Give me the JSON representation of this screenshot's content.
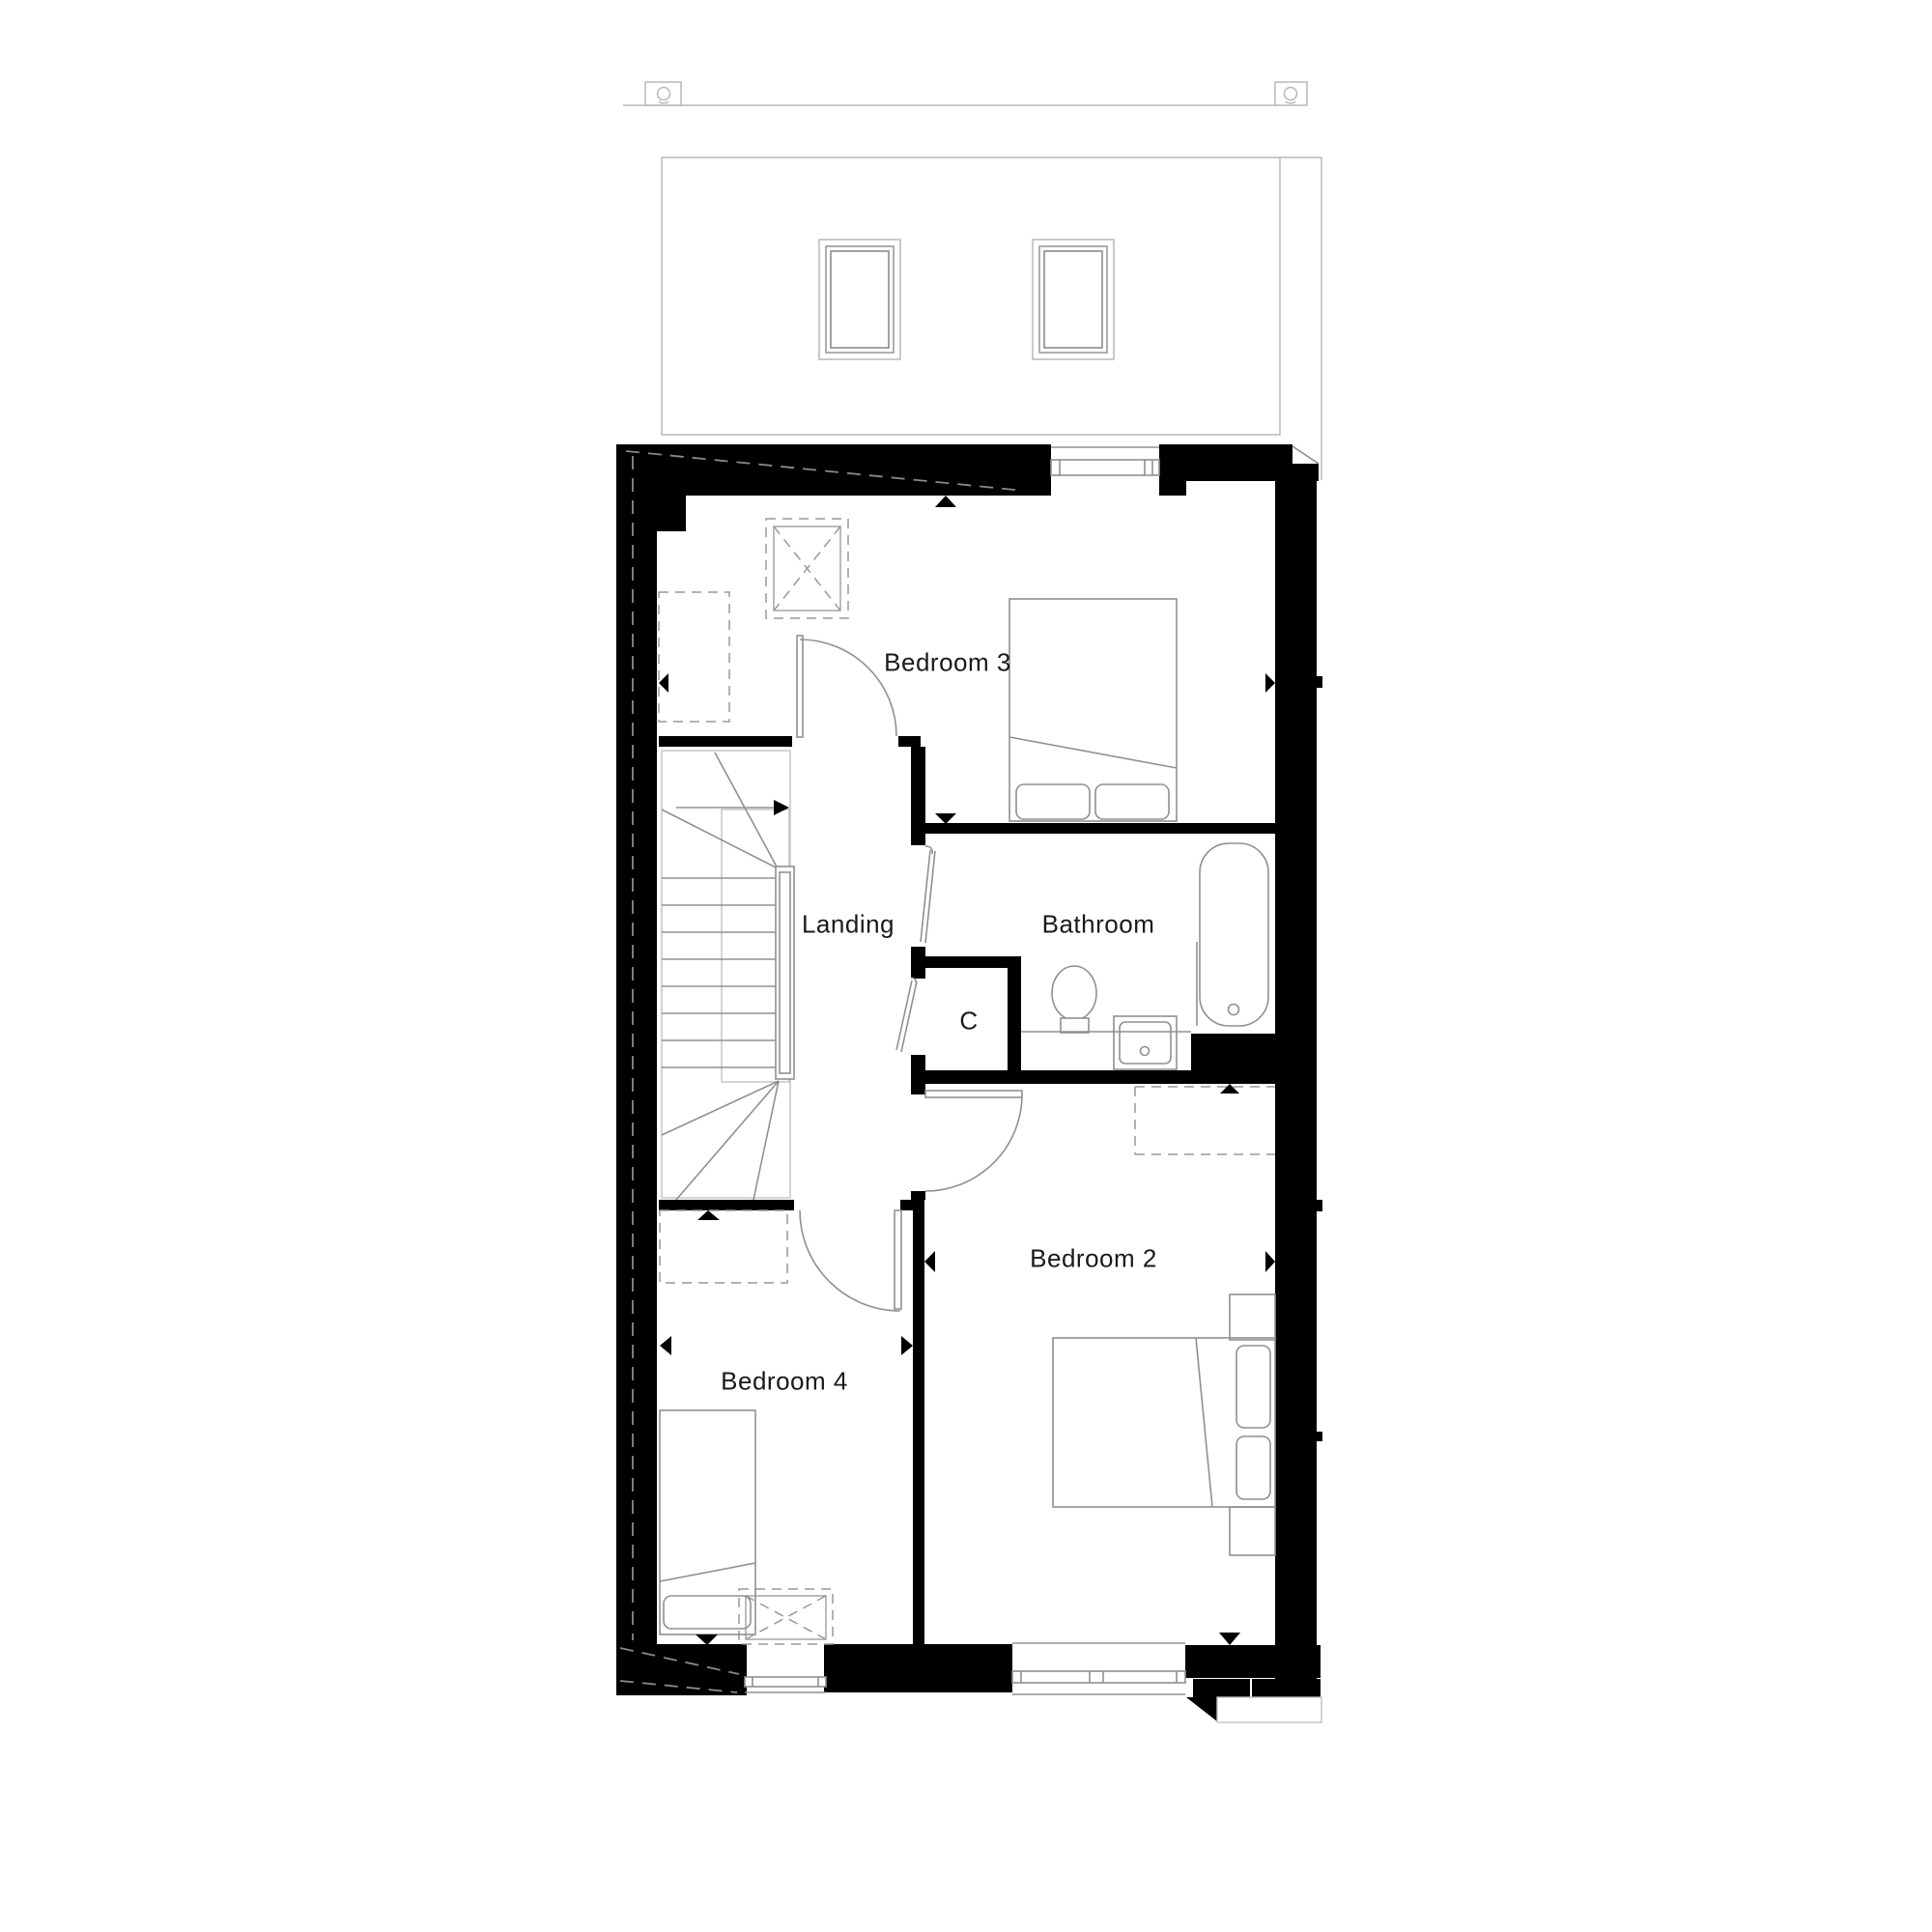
{
  "drawing": {
    "type": "first-floor plan",
    "rooms": [
      {
        "id": "bedroom3",
        "label": "Bedroom 3"
      },
      {
        "id": "landing",
        "label": "Landing"
      },
      {
        "id": "bathroom",
        "label": "Bathroom"
      },
      {
        "id": "closet",
        "label": "C"
      },
      {
        "id": "bedroom2",
        "label": "Bedroom 2"
      },
      {
        "id": "bedroom4",
        "label": "Bedroom 4"
      }
    ],
    "symbols": [
      "roof-outline",
      "skylight-icon",
      "vent-icon",
      "loft-hatch-icon",
      "stairs-icon",
      "bed-icon",
      "bath-icon",
      "toilet-icon",
      "basin-icon",
      "door-swing-icon",
      "window-icon",
      "direction-triangle-icon",
      "wardrobe-dashed-outline",
      "eaves-storage-dashed-outline"
    ]
  },
  "colors": {
    "wall": "#000000",
    "fixture": "#909090",
    "light": "#c2c2c2",
    "roof": "#b8b8b8",
    "dashed": "#999999",
    "ink": "#1a1a1a",
    "bg": "#ffffff"
  }
}
